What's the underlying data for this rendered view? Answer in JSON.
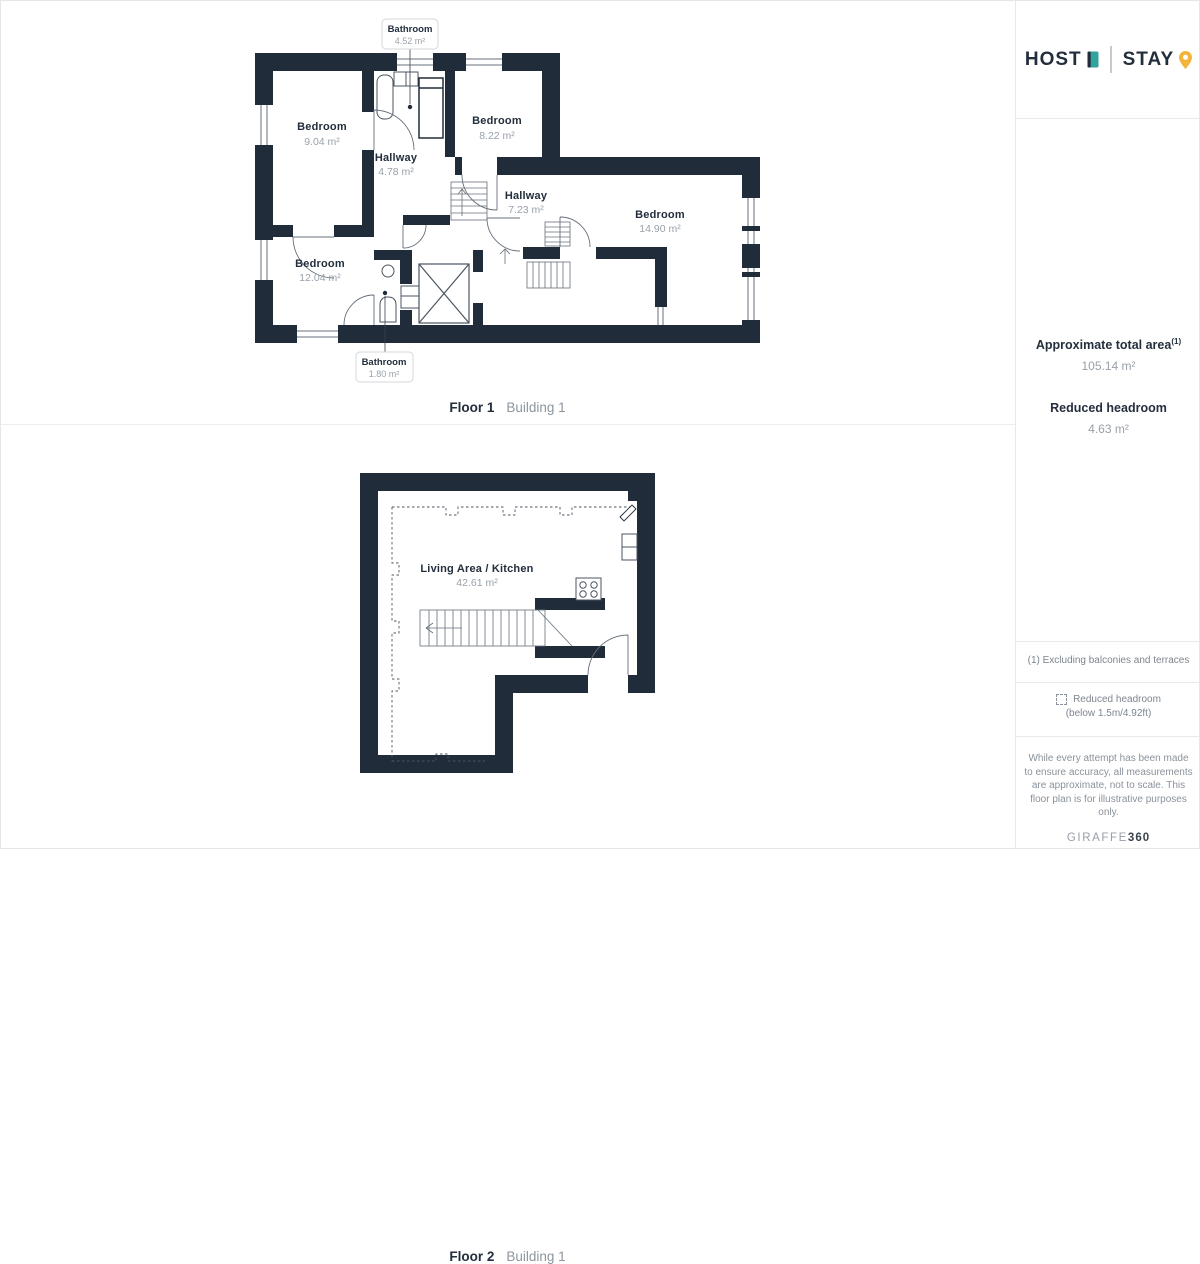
{
  "brand": {
    "host": "HOST",
    "stay": "STAY"
  },
  "colors": {
    "wall": "#212c3a",
    "accent_teal": "#2fa39c",
    "accent_amber": "#f3b43b"
  },
  "sidebar": {
    "total_area_label": "Approximate total area",
    "total_area_footnote_marker": "(1)",
    "total_area_value": "105.14 m²",
    "reduced_headroom_label": "Reduced headroom",
    "reduced_headroom_value": "4.63 m²",
    "footnote": "(1) Excluding balconies and terraces",
    "legend_title": "Reduced headroom",
    "legend_subtitle": "(below 1.5m/4.92ft)",
    "disclaimer": "While every attempt has been made to ensure accuracy, all measurements are approximate, not to scale. This floor plan is for illustrative purposes only.",
    "credit_brand": "GIRAFFE",
    "credit_suffix": "360"
  },
  "floors": [
    {
      "caption_floor": "Floor 1",
      "caption_building": "Building 1",
      "rooms": [
        {
          "name": "Bedroom",
          "area": "9.04 m²"
        },
        {
          "name": "Bedroom",
          "area": "8.22 m²"
        },
        {
          "name": "Hallway",
          "area": "4.78 m²"
        },
        {
          "name": "Hallway",
          "area": "7.23 m²"
        },
        {
          "name": "Bedroom",
          "area": "14.90 m²"
        },
        {
          "name": "Bedroom",
          "area": "12.04 m²"
        }
      ],
      "callouts": [
        {
          "name": "Bathroom",
          "area": "4.52 m²"
        },
        {
          "name": "Bathroom",
          "area": "1.80 m²"
        }
      ]
    },
    {
      "caption_floor": "Floor 2",
      "caption_building": "Building 1",
      "rooms": [
        {
          "name": "Living Area / Kitchen",
          "area": "42.61 m²"
        }
      ]
    }
  ]
}
